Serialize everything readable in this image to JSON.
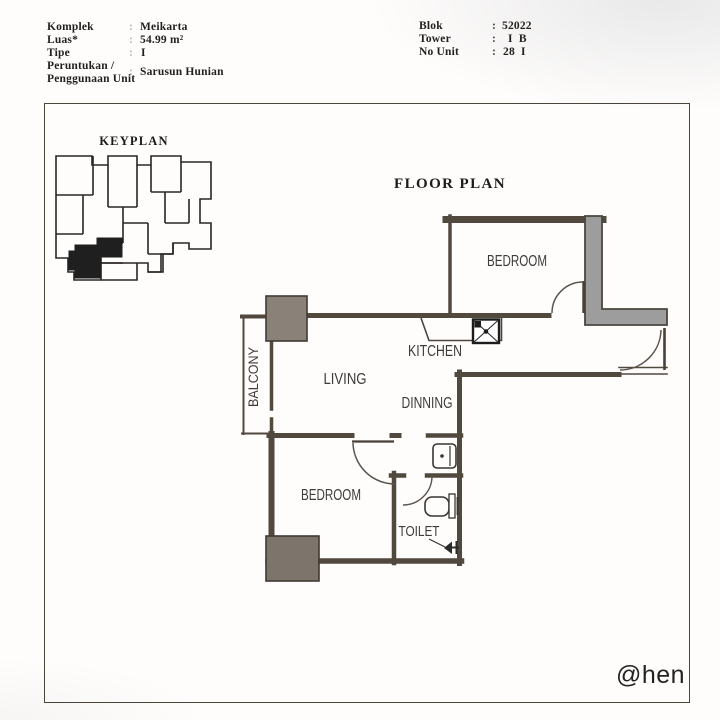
{
  "header": {
    "sep": ":",
    "left": [
      {
        "label": "Komplek",
        "value": "Meikarta"
      },
      {
        "label": "Luas*",
        "value": "54.99 m²"
      },
      {
        "label": "Tipe",
        "value": "I"
      },
      {
        "label": "Peruntukan /",
        "label2": "Penggunaan Unit",
        "value": "Sarusun Hunian"
      }
    ],
    "right": [
      {
        "label": "Blok",
        "value": "52022"
      },
      {
        "label": "Tower",
        "value": "I  B"
      },
      {
        "label": "No Unit",
        "value": "28  I"
      }
    ]
  },
  "keyplan": {
    "title": "KEYPLAN"
  },
  "floorplan": {
    "title": "FLOOR PLAN",
    "rooms": {
      "bedroom_top": "BEDROOM",
      "kitchen": "KITCHEN",
      "living": "LIVING",
      "dinning": "DINNING",
      "bedroom_bottom": "BEDROOM",
      "toilet": "TOILET",
      "balcony": "BALCONY"
    }
  },
  "watermark": "@hen",
  "colors": {
    "wall": "#51483e",
    "thick_wall_fill": "#9d9d9d",
    "column_fill": "#837a70",
    "keyplan_unit_fill": "#1f1f1f",
    "ink": "#221f1c"
  }
}
